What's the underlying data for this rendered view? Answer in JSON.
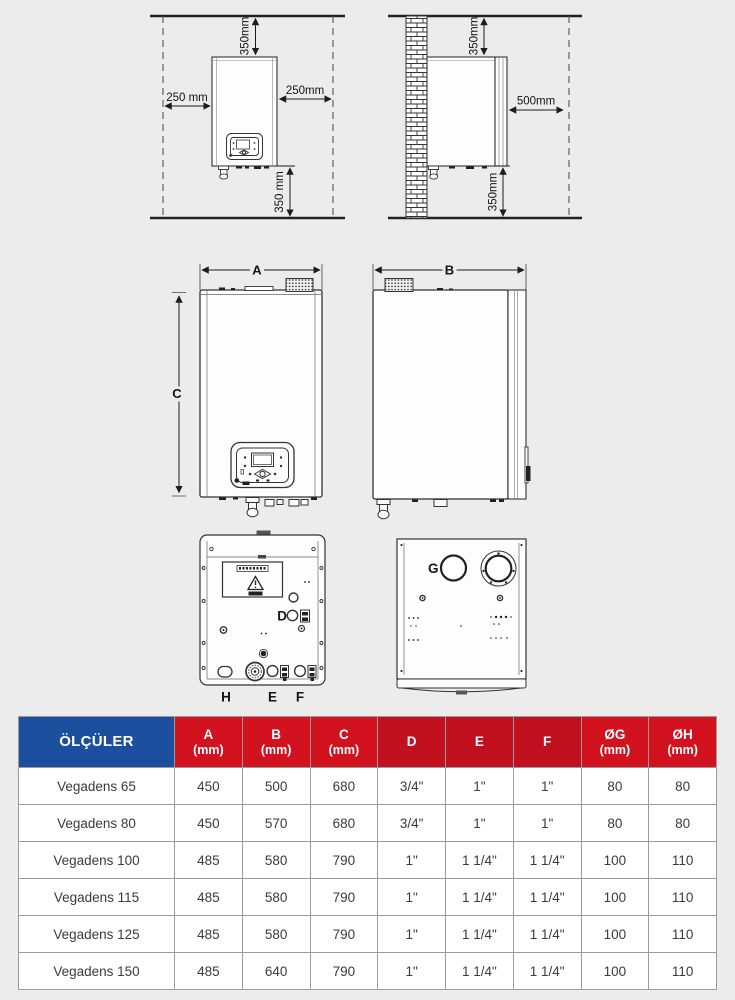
{
  "colors": {
    "page_bg": "#ececec",
    "drawing_line": "#333333",
    "header_blue": "#1c4f9e",
    "header_red": "#d2121f",
    "header_red_dark": "#c1111e",
    "table_border": "#9b9b9b",
    "body_text": "#3b3b3b"
  },
  "clearance_front": {
    "top": "350mm",
    "left": "250 mm",
    "right": "250mm",
    "bottom": "350 mm"
  },
  "clearance_side": {
    "top": "350mm",
    "front": "500mm",
    "bottom": "350mm"
  },
  "view_labels": {
    "a": "A",
    "b": "B",
    "c": "C",
    "d": "D",
    "e": "E",
    "f": "F",
    "g": "G",
    "h": "H"
  },
  "table": {
    "header": [
      {
        "line1": "ÖLÇÜLER",
        "line2": ""
      },
      {
        "line1": "A",
        "line2": "(mm)"
      },
      {
        "line1": "B",
        "line2": "(mm)"
      },
      {
        "line1": "C",
        "line2": "(mm)"
      },
      {
        "line1": "D",
        "line2": ""
      },
      {
        "line1": "E",
        "line2": ""
      },
      {
        "line1": "F",
        "line2": ""
      },
      {
        "line1": "ØG",
        "line2": "(mm)"
      },
      {
        "line1": "ØH",
        "line2": "(mm)"
      }
    ],
    "rows": [
      {
        "model": "Vegadens 65",
        "a": "450",
        "b": "500",
        "c": "680",
        "d": "3/4\"",
        "e": "1\"",
        "f": "1\"",
        "og": "80",
        "oh": "80"
      },
      {
        "model": "Vegadens 80",
        "a": "450",
        "b": "570",
        "c": "680",
        "d": "3/4\"",
        "e": "1\"",
        "f": "1\"",
        "og": "80",
        "oh": "80"
      },
      {
        "model": "Vegadens 100",
        "a": "485",
        "b": "580",
        "c": "790",
        "d": "1\"",
        "e": "1 1/4\"",
        "f": "1 1/4\"",
        "og": "100",
        "oh": "110"
      },
      {
        "model": "Vegadens 115",
        "a": "485",
        "b": "580",
        "c": "790",
        "d": "1\"",
        "e": "1 1/4\"",
        "f": "1 1/4\"",
        "og": "100",
        "oh": "110"
      },
      {
        "model": "Vegadens 125",
        "a": "485",
        "b": "580",
        "c": "790",
        "d": "1\"",
        "e": "1 1/4\"",
        "f": "1 1/4\"",
        "og": "100",
        "oh": "110"
      },
      {
        "model": "Vegadens 150",
        "a": "485",
        "b": "640",
        "c": "790",
        "d": "1\"",
        "e": "1 1/4\"",
        "f": "1 1/4\"",
        "og": "100",
        "oh": "110"
      }
    ]
  }
}
